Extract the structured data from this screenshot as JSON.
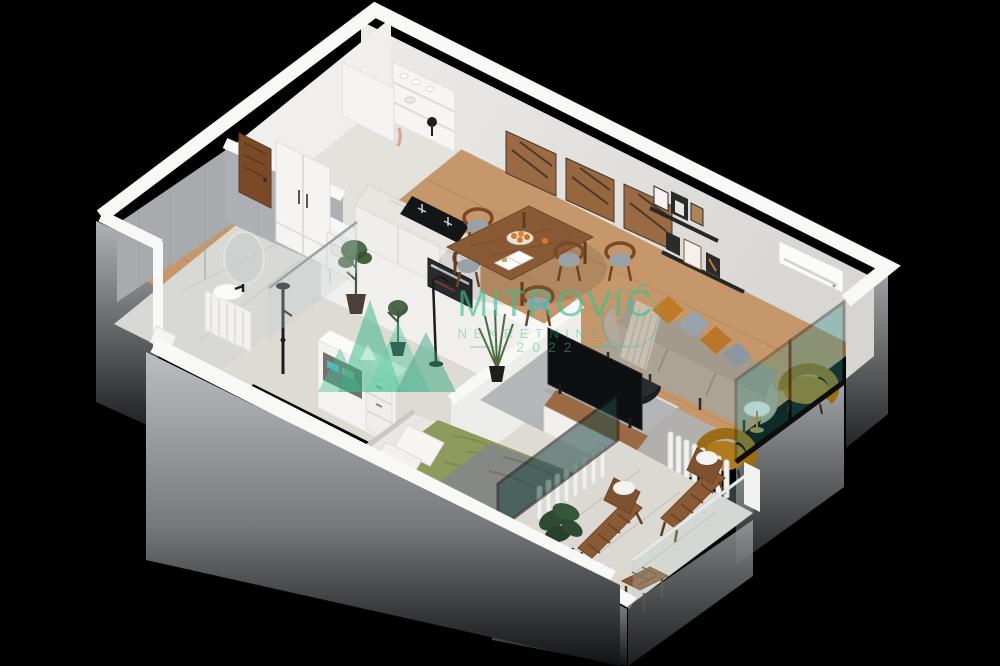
{
  "watermark": {
    "brand": "MITROVIĆ",
    "subtitle": "NEKRETNINE",
    "year": "2022",
    "accent_color": "#3fbf92"
  },
  "scene": {
    "type": "isometric-3d-floor-plan-render",
    "background": "#000000",
    "rooms": [
      {
        "name": "kitchen",
        "furniture": [
          "wall-dish-shelf",
          "induction-stove-oven",
          "marble-counter",
          "tall-cabinet",
          "potted-plant",
          "floor-lamp"
        ]
      },
      {
        "name": "dining-area",
        "furniture": [
          "walnut-table",
          "bentwood-chairs-x5",
          "fruit-plate",
          "open-magazine"
        ]
      },
      {
        "name": "living-room",
        "furniture": [
          "taupe-sofa",
          "throw-blanket",
          "orange-pillows",
          "gray-pillows",
          "black-round-coffee-table",
          "gray-rug",
          "tv",
          "media-console",
          "grass-plant",
          "mustard-armchair-x2",
          "marble-side-table",
          "radiator",
          "wood-art-panels-x3",
          "picture-ledges",
          "air-conditioner"
        ]
      },
      {
        "name": "entry-hall",
        "furniture": [
          "wood-entrance-door",
          "white-wardrobe",
          "console-table"
        ]
      },
      {
        "name": "bathroom",
        "furniture": [
          "round-mirror",
          "vanity-with-basin",
          "black-shower-column",
          "glass-shower-screen",
          "toilet"
        ]
      },
      {
        "name": "bedroom",
        "furniture": [
          "double-bed-green-duvet",
          "gray-blanket",
          "white-pillows",
          "open-dresser-with-clothes",
          "radiator",
          "window"
        ]
      },
      {
        "name": "balcony",
        "furniture": [
          "wood-deck-chair-x2",
          "slat-stool",
          "potted-plant",
          "glass-balustrade",
          "white-parapet"
        ]
      }
    ],
    "palette": {
      "wood_floor": "#c6976a",
      "white_wall_band": "#f8f8f7",
      "interior_wall": "#e7e5e1",
      "tile_gray": "#a7abae",
      "sofa_taupe": "#aaa195",
      "accent_orange": "#c07a2a",
      "accent_mustard": "#b07a1e",
      "duvet_green": "#8f9a5e",
      "glass_teal": "#2f8f86",
      "rug_gray": "#b0b2b3",
      "carpet": "#dedbd4",
      "outer_facade": "#9b9ea0",
      "walnut": "#8a5a35"
    }
  }
}
